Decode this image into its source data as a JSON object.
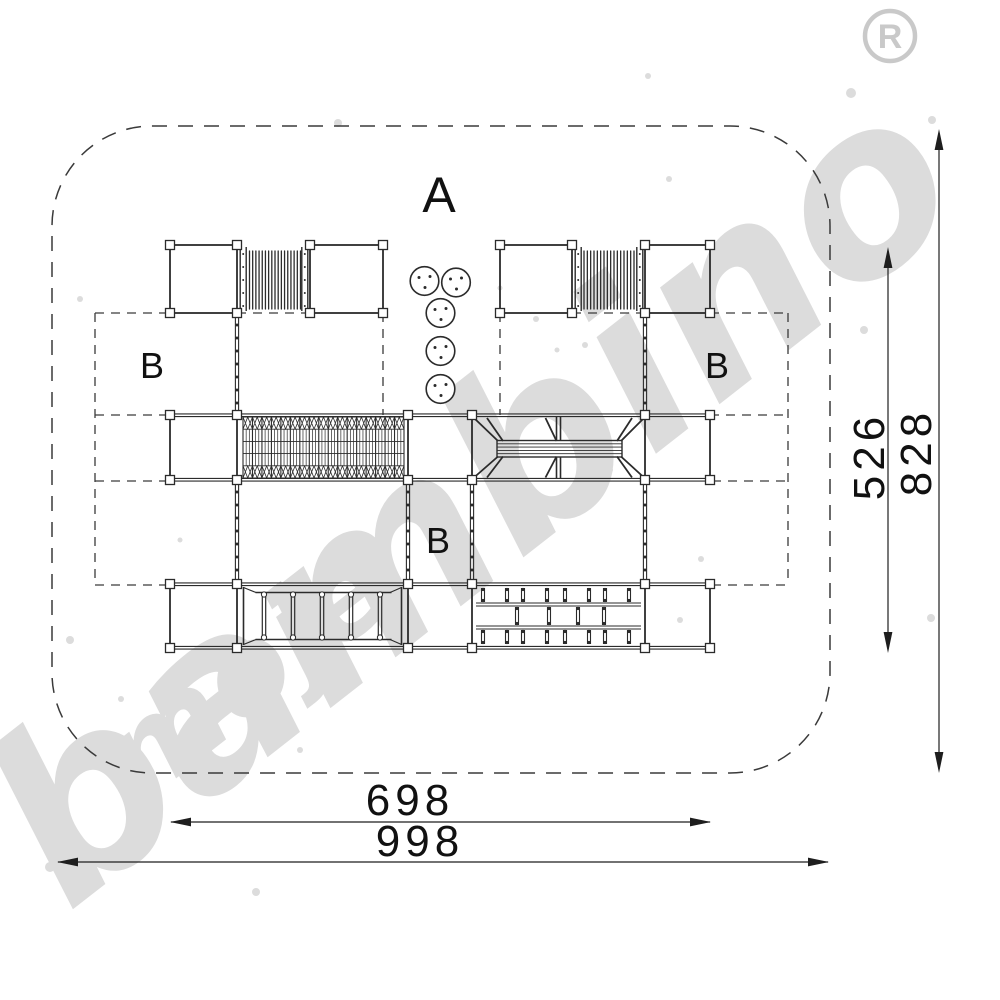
{
  "zone_labels": {
    "zone_a": "A",
    "zone_b_left": "B",
    "zone_b_right": "B",
    "zone_b_center": "B"
  },
  "dimensions": {
    "inner_width": "698",
    "outer_width": "998",
    "inner_height": "526",
    "outer_height": "828"
  },
  "watermark": {
    "word_small": "moje",
    "word_big": "bambino",
    "registered_letter": "R"
  },
  "colors": {
    "background": "#ffffff",
    "line": "#2b2b2b",
    "dashed_line": "#3a3a3a",
    "dimension": "#1e1e1e",
    "watermark": "#dcdcdc"
  }
}
